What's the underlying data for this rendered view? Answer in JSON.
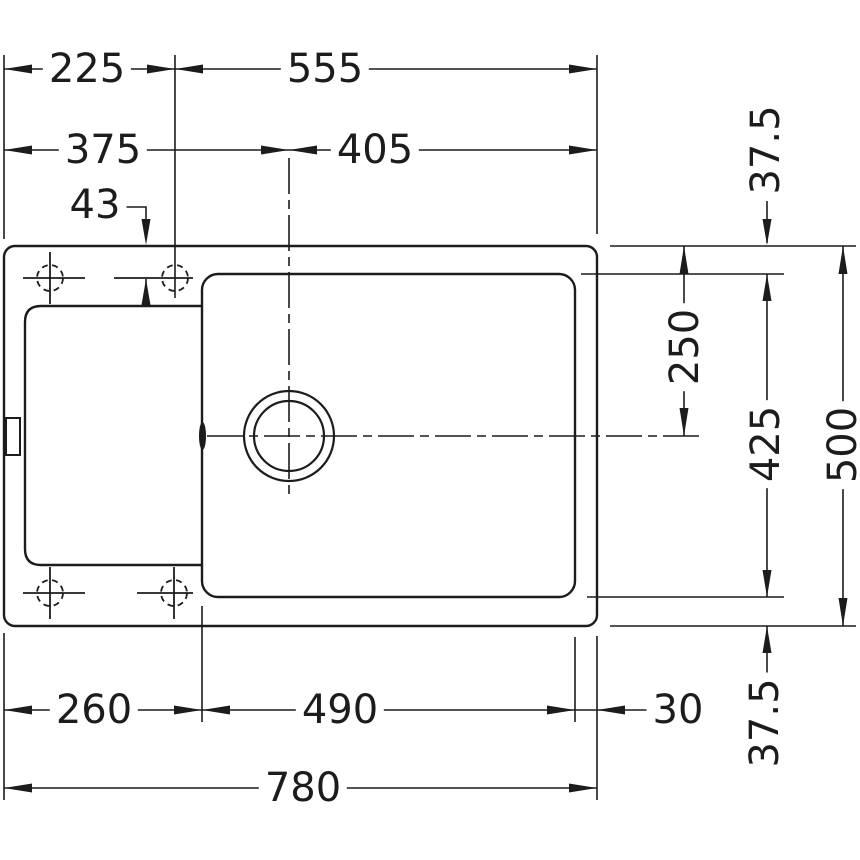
{
  "drawing": {
    "type": "technical-dimension-drawing",
    "subject": "inset kitchen sink with drainboard, single bowl and drain hole (top view)",
    "background": "#ffffff",
    "line_color": "#1c1c1c",
    "dimensions": {
      "top_left_to_tapholes": "225",
      "tapholes_to_right": "555",
      "left_to_drain_center": "375",
      "drain_center_to_right": "405",
      "rim_to_taphole_center": "43",
      "top_to_bowl_centerline": "250",
      "rim_to_bowl_top": "37.5",
      "bowl_height": "425",
      "overall_depth": "500",
      "bowl_to_rim_bottom": "37.5",
      "left_to_bowl": "260",
      "bowl_width": "490",
      "bowl_to_right_edge": "30",
      "overall_width": "780"
    }
  }
}
